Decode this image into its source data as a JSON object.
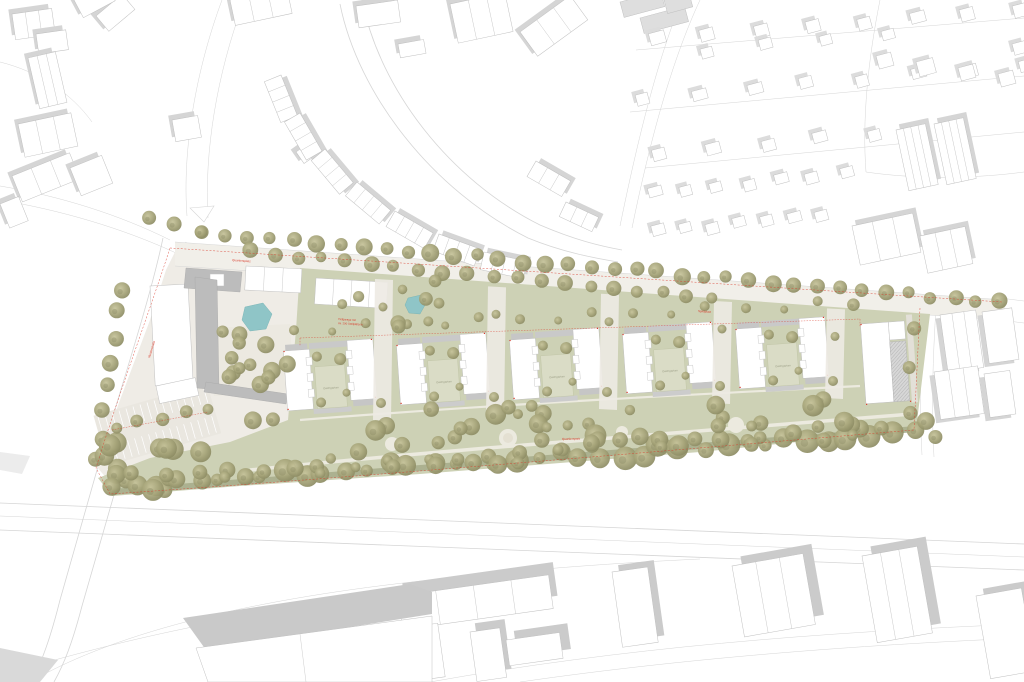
{
  "labels": {
    "roof_garden": "Dachgarten",
    "underground_garage_1": "Tiefgarage mit",
    "underground_garage_2": "ca. 290 Stellplätzen",
    "park": "Quartierspark",
    "plaza": "Quartiersplatz",
    "street_west": "Musterstraße",
    "playground": "Spielplatz"
  },
  "colors": {
    "background": "#ffffff",
    "paving": "#f1efe9",
    "plaza_paving": "#efece6",
    "park_green": "#cdd1b5",
    "roof_garden_green": "#dadcc6",
    "hedge_green": "#a9ad8c",
    "tree_olive": "#a5a378",
    "water_teal": "#8fc5c7",
    "building_outline": "#c0c0c0",
    "roof_gray": "#bcbcbc",
    "shadow_gray": "#d5d5d5",
    "road_line": "#d6d6d6",
    "boundary_red": "#d93b2b"
  }
}
